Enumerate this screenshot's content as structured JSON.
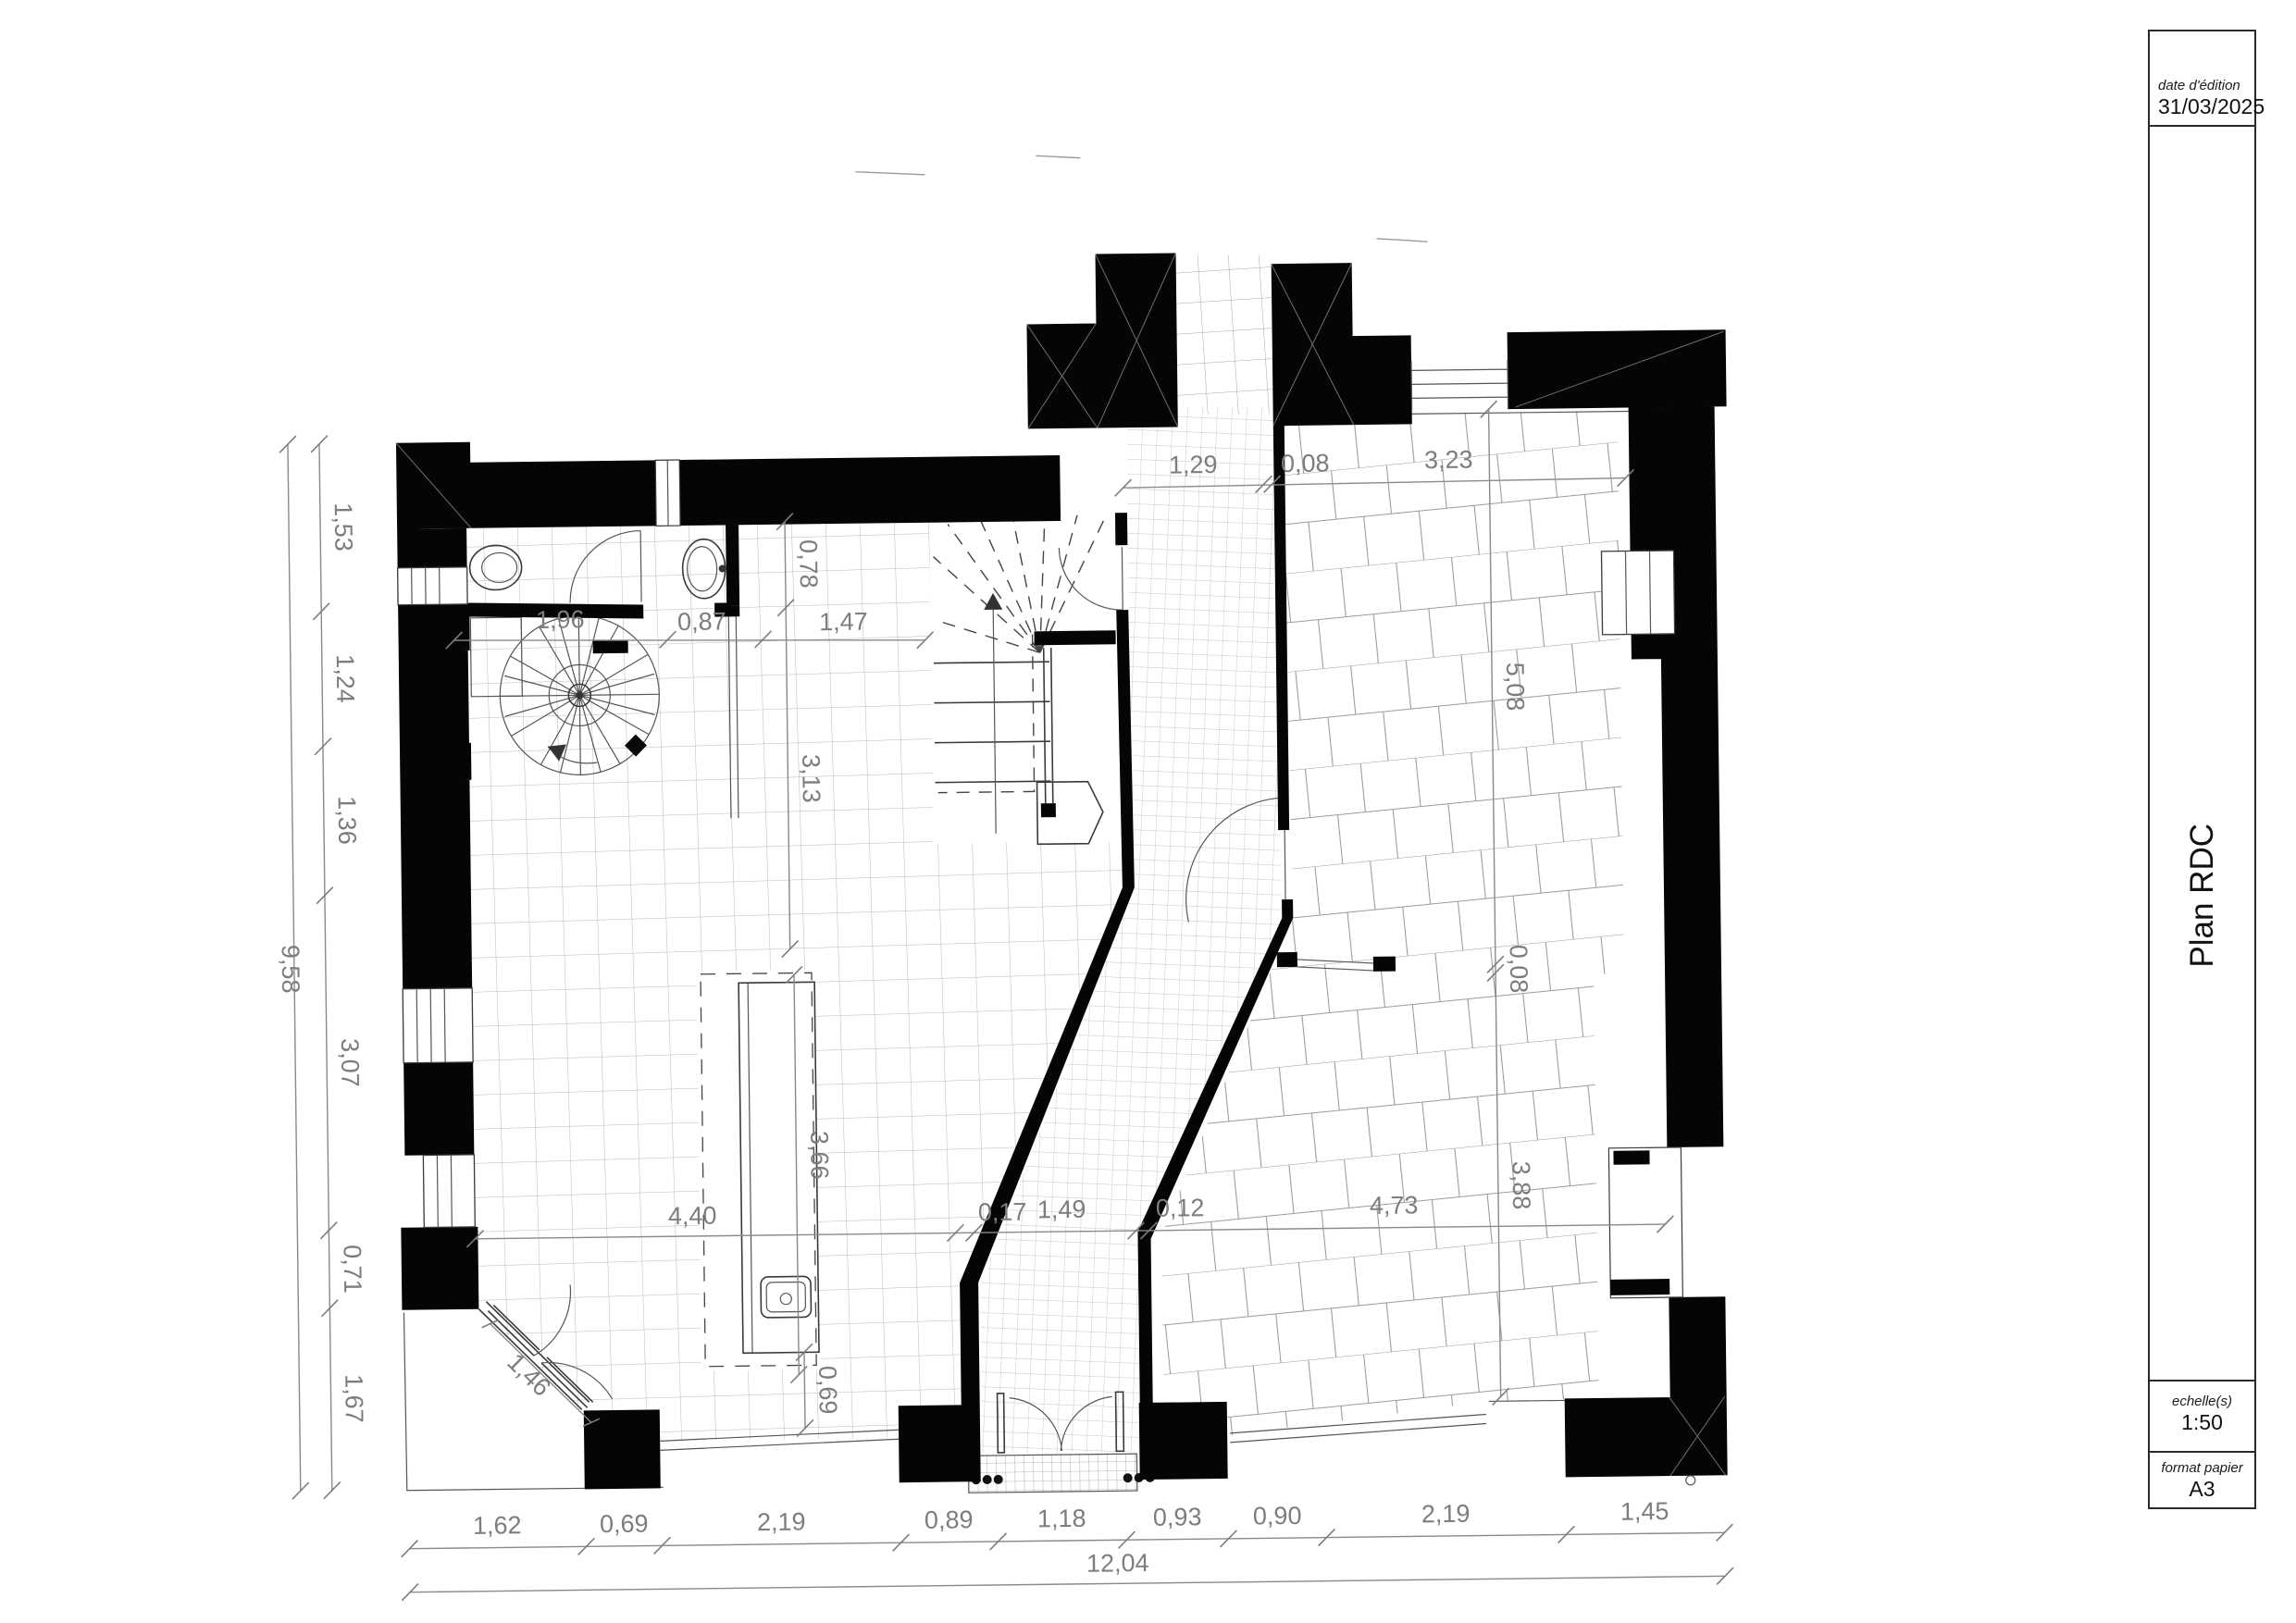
{
  "title_block": {
    "date_label": "date d'édition",
    "date_value": "31/03/2025",
    "drawing_title": "Plan RDC",
    "scale_label": "echelle(s)",
    "scale_value": "1:50",
    "paper_label": "format papier",
    "paper_value": "A3"
  },
  "dims": {
    "bottom": [
      "1,62",
      "0,69",
      "2,19",
      "0,89",
      "1,18",
      "0,93",
      "0,90",
      "2,19",
      "1,45"
    ],
    "bottom_total": "12,04",
    "left": [
      "1,53",
      "1,24",
      "1,36",
      "3,07",
      "0,71",
      "1,67"
    ],
    "left_total": "9,58",
    "top_line": [
      "1,29",
      "0,08",
      "3,23"
    ],
    "wc_line": [
      "1,96",
      "0,87",
      "1,47"
    ],
    "mid_line": [
      "4,40",
      "0,17",
      "1,49",
      "0,12",
      "4,73"
    ],
    "right_line": [
      "5,08",
      "0,08",
      "3,88"
    ],
    "interior": {
      "basin_height": "0,78",
      "hall_length": "3,13",
      "counter_length": "3,66",
      "counter_width": "0,69",
      "chamfer_door": "1,46"
    }
  }
}
